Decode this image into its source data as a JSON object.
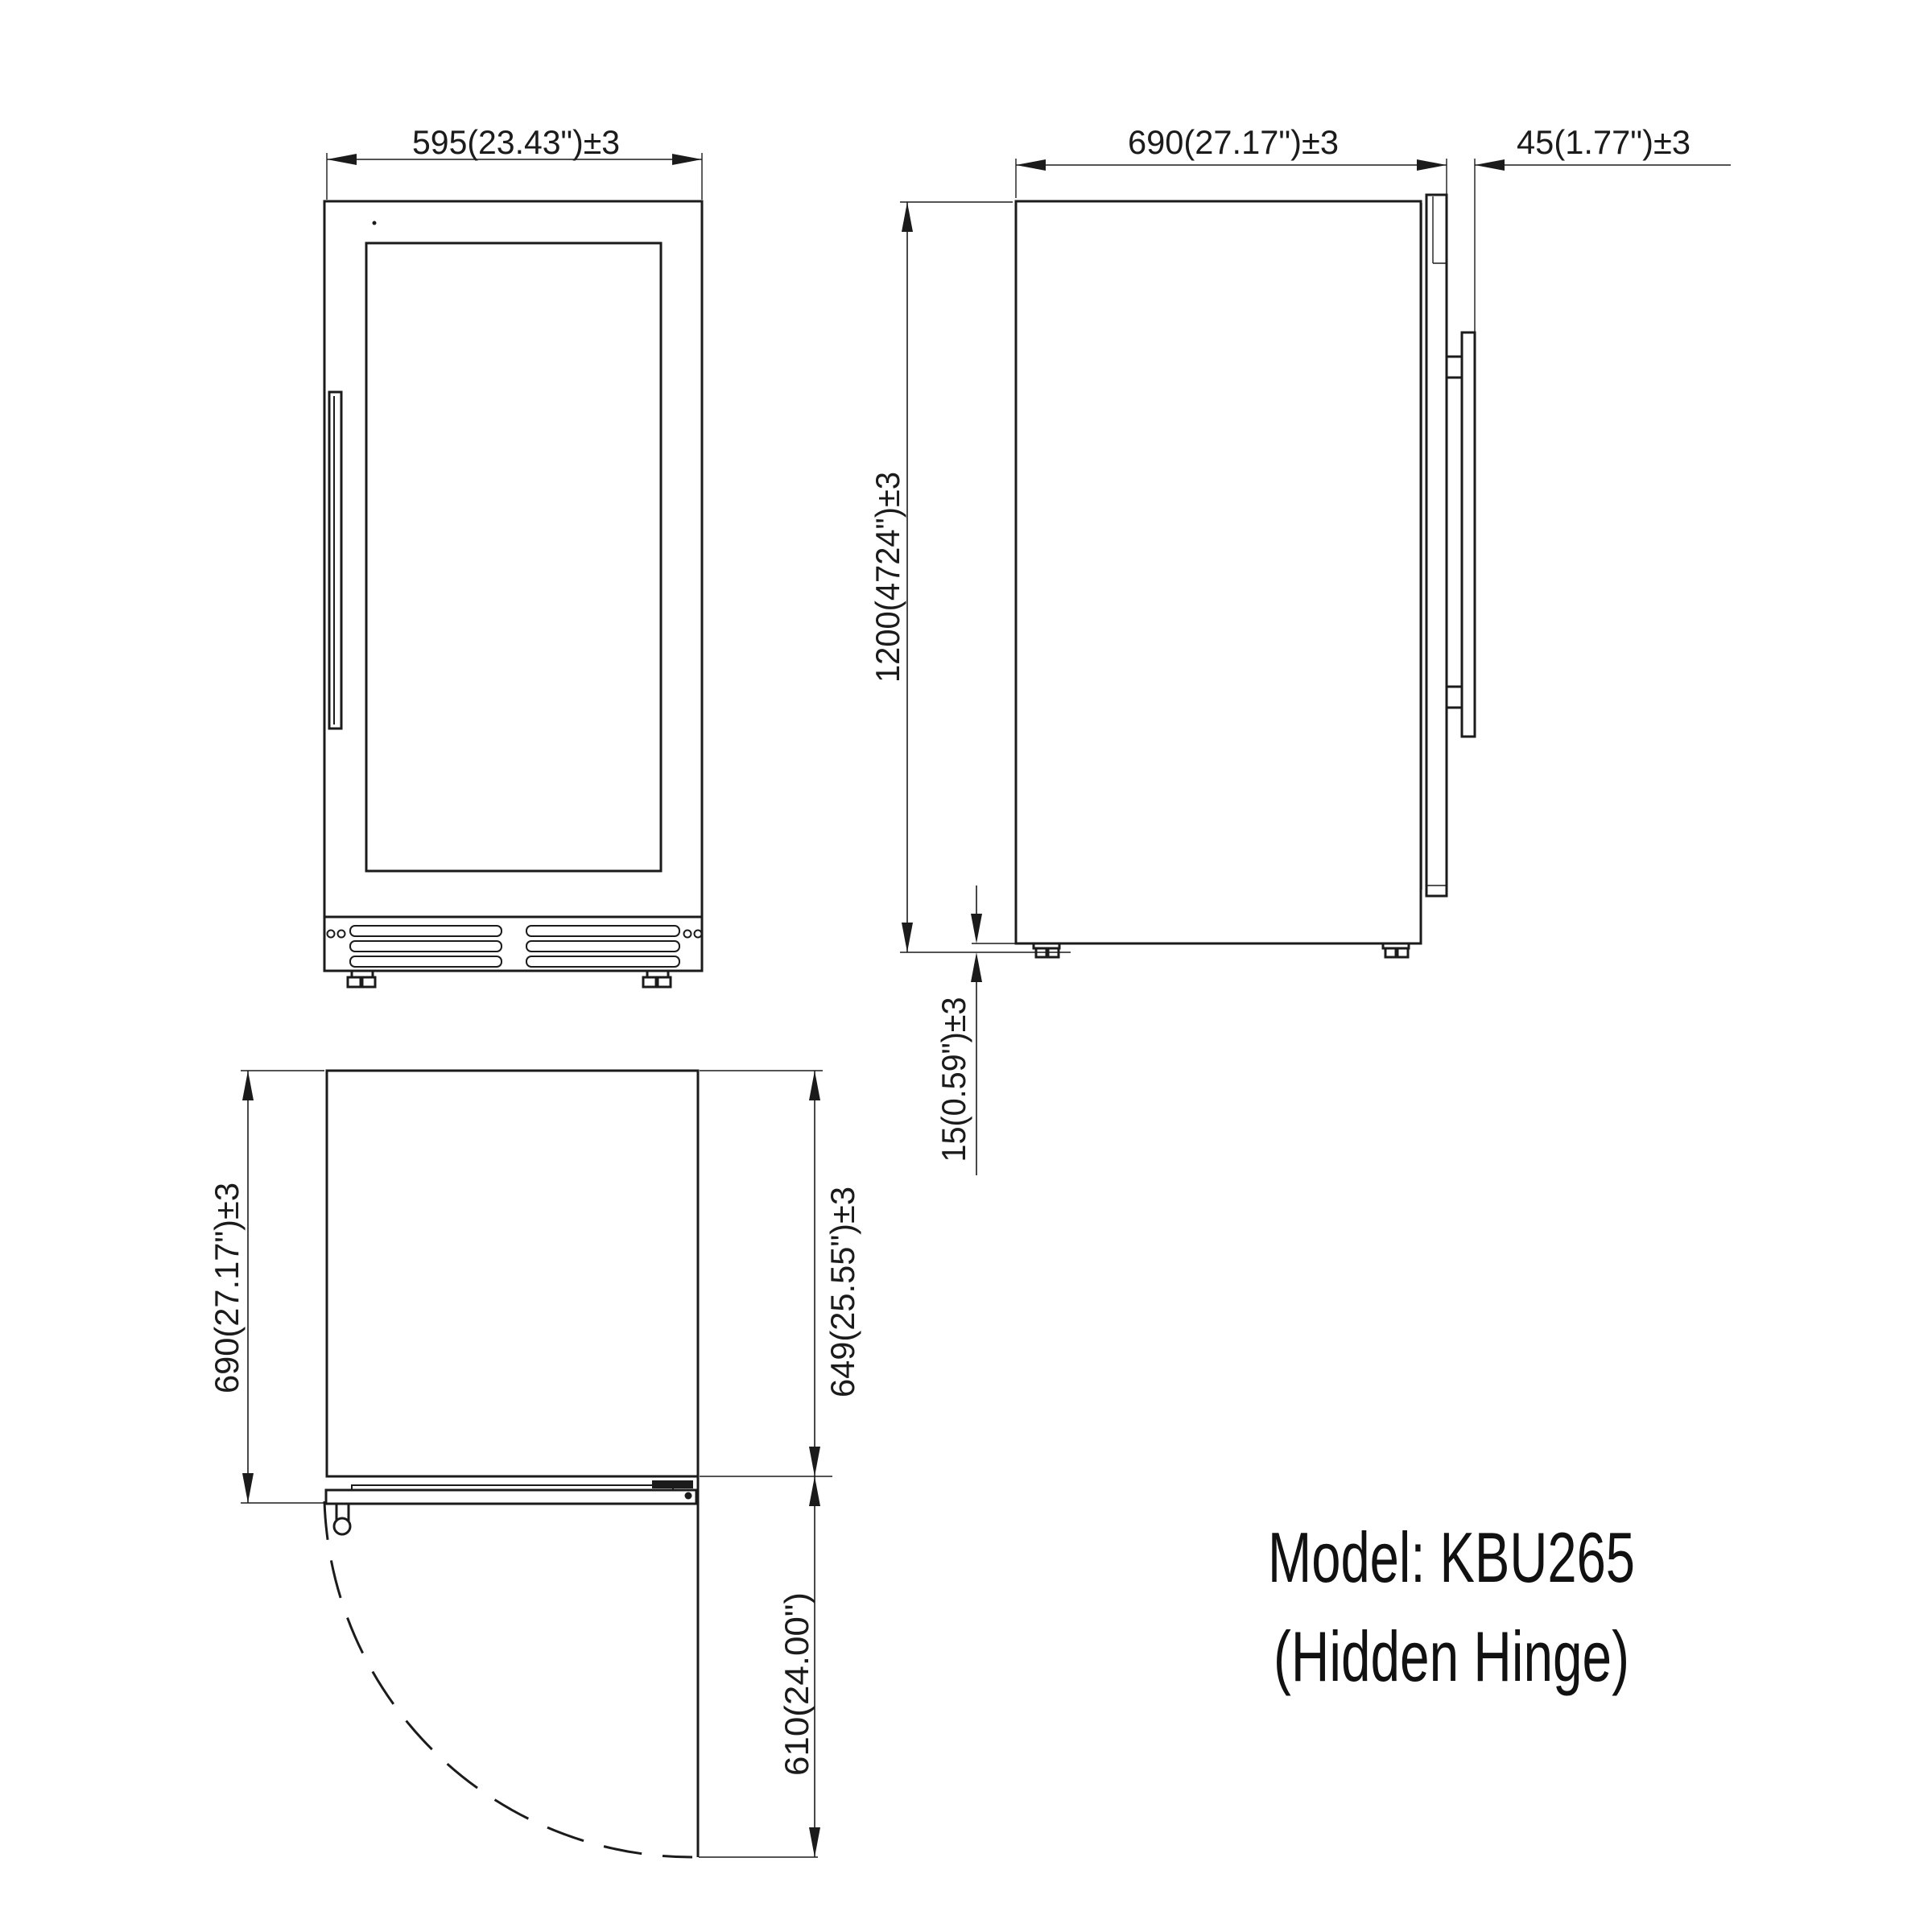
{
  "drawing": {
    "model_line1": "Model: KBU265",
    "model_line2": "(Hidden Hinge)",
    "colors": {
      "line": "#1b1b1b",
      "background": "#ffffff"
    }
  },
  "front_view": {
    "width_dim": "595(23.43\")±3"
  },
  "side_view": {
    "depth_dim": "690(27.17\")±3",
    "door_thickness_dim": "45(1.77\")±3",
    "height_dim": "1200(4724\")±3",
    "foot_height_dim": "15(0.59\")±3"
  },
  "top_view": {
    "overall_depth_dim": "690(27.17\")±3",
    "body_depth_dim": "649(25.55\")±3",
    "door_clearance_dim": "610(24.00\")"
  }
}
